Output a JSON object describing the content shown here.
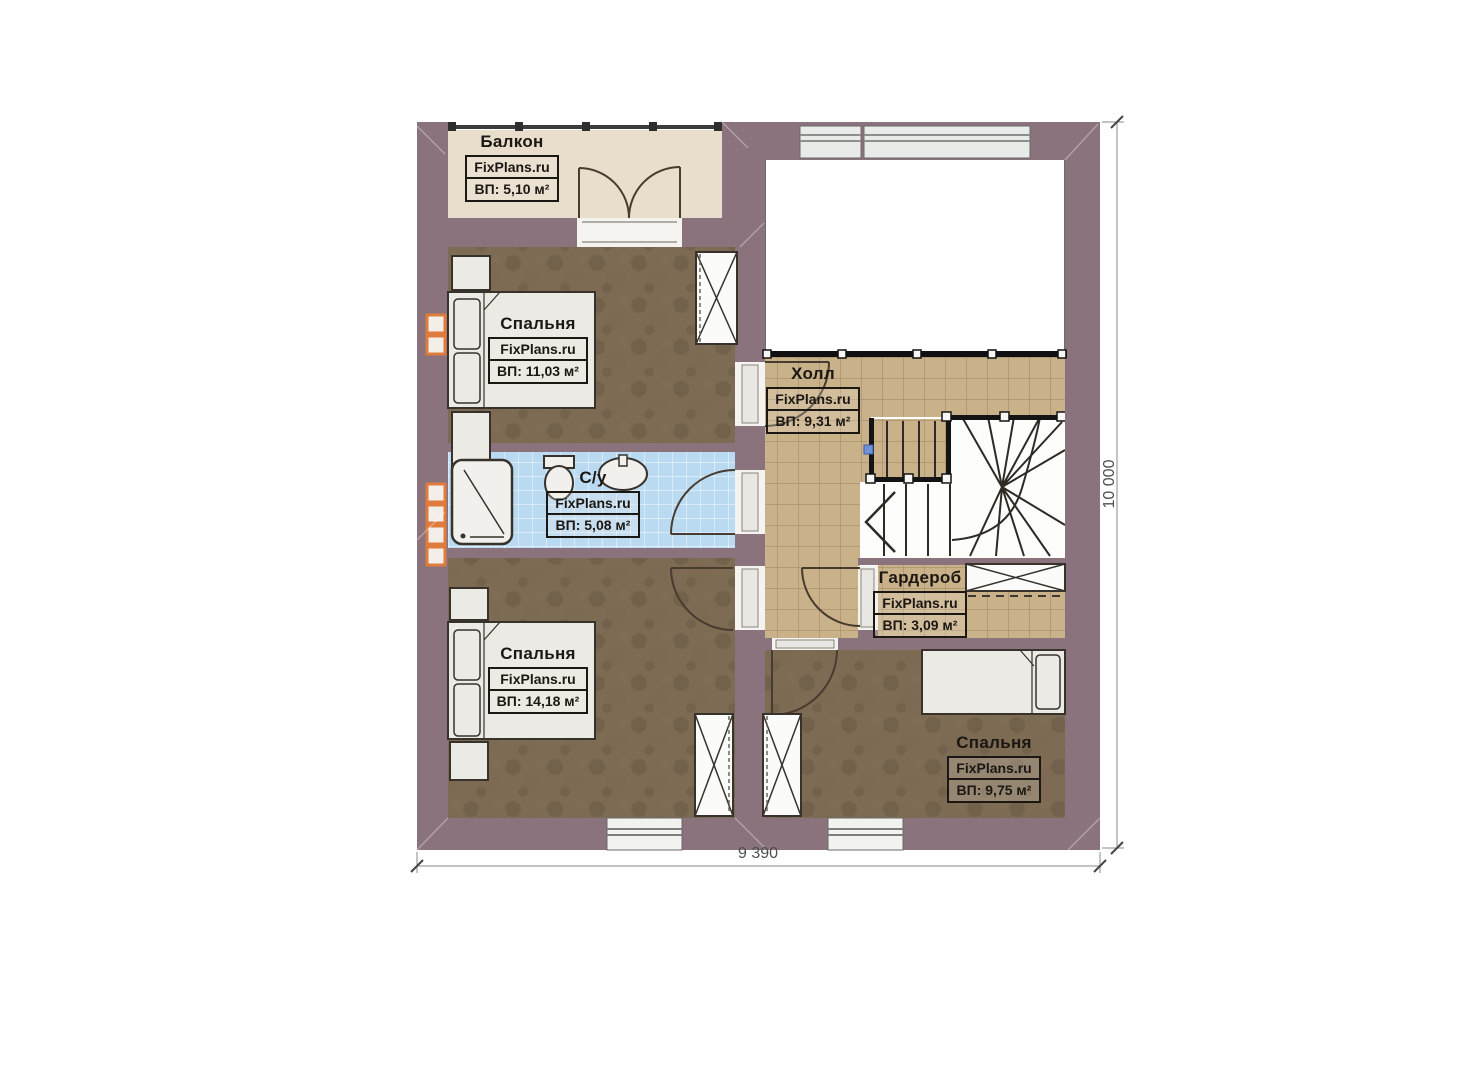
{
  "rooms": [
    {
      "key": "balcony",
      "name": "Балкон",
      "brand": "FixPlans.ru",
      "area_label": "ВП: 5,10 м²"
    },
    {
      "key": "bedroom-top-left",
      "name": "Спальня",
      "brand": "FixPlans.ru",
      "area_label": "ВП: 11,03 м²"
    },
    {
      "key": "bathroom",
      "name": "С/у",
      "brand": "FixPlans.ru",
      "area_label": "ВП: 5,08 м²"
    },
    {
      "key": "hall",
      "name": "Холл",
      "brand": "FixPlans.ru",
      "area_label": "ВП: 9,31 м²"
    },
    {
      "key": "wardrobe",
      "name": "Гардероб",
      "brand": "FixPlans.ru",
      "area_label": "ВП: 3,09 м²"
    },
    {
      "key": "bedroom-bottom-left",
      "name": "Спальня",
      "brand": "FixPlans.ru",
      "area_label": "ВП: 14,18 м²"
    },
    {
      "key": "bedroom-bottom-right",
      "name": "Спальня",
      "brand": "FixPlans.ru",
      "area_label": "ВП: 9,75 м²"
    }
  ],
  "dimensions": {
    "width_label": "9 390",
    "height_label": "10 000"
  },
  "colors": {
    "wall": "#8b737e",
    "bedroom_floor": "#7d6b53",
    "hall_tile": "#c9b189",
    "balcony_floor": "#e8decb",
    "bathroom_tile": "#badaf2",
    "vent_accent": "#de7b3d",
    "railing": "#141414",
    "marker_dot": "#6f92d5"
  }
}
